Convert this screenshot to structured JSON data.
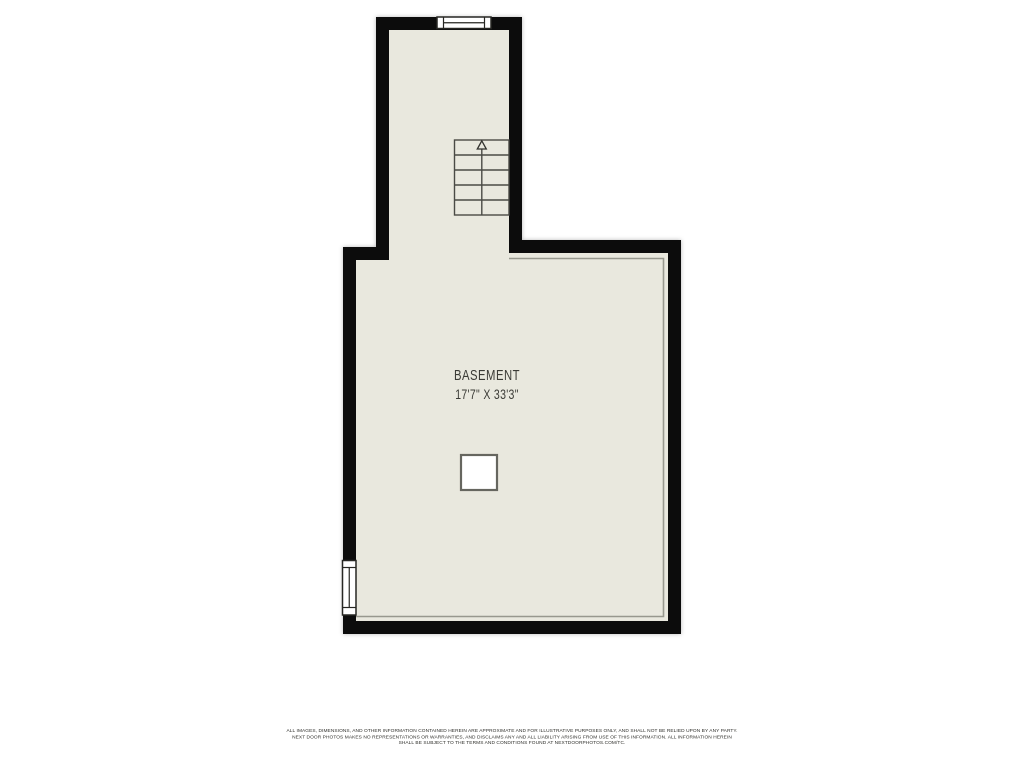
{
  "floor_plan": {
    "room": {
      "name": "BASEMENT",
      "dimensions": "17'7\" X 33'3\""
    },
    "symbols": {
      "staircase": "stairs-with-up-arrow",
      "window_top": "window",
      "window_left": "window",
      "support_post": "square-post"
    }
  },
  "footer": {
    "disclaimer_lines": [
      "ALL IMAGES, DIMENSIONS, AND OTHER INFORMATION CONTAINED HEREIN ARE APPROXIMATE AND FOR ILLUSTRATIVE PURPOSES ONLY, AND SHALL NOT BE RELIED UPON BY ANY PARTY.",
      "NEXT DOOR PHOTOS MAKES NO REPRESENTATIONS OR WARRANTIES, AND DISCLAIMS ANY AND ALL LIABILITY ARISING FROM USE OF THIS INFORMATION. ALL INFORMATION HEREIN",
      "SHALL BE SUBJECT TO THE TERMS AND CONDITIONS FOUND AT NEXTDOORPHOTOS.COM/TC."
    ]
  },
  "colors": {
    "background": "#ffffff",
    "floor": "#e9e8de",
    "wall": "#0c0c0c",
    "inner-line": "#98988e",
    "symbol-stroke": "#4a4a45",
    "window-stroke": "#272723",
    "text": "#3b3b36"
  }
}
